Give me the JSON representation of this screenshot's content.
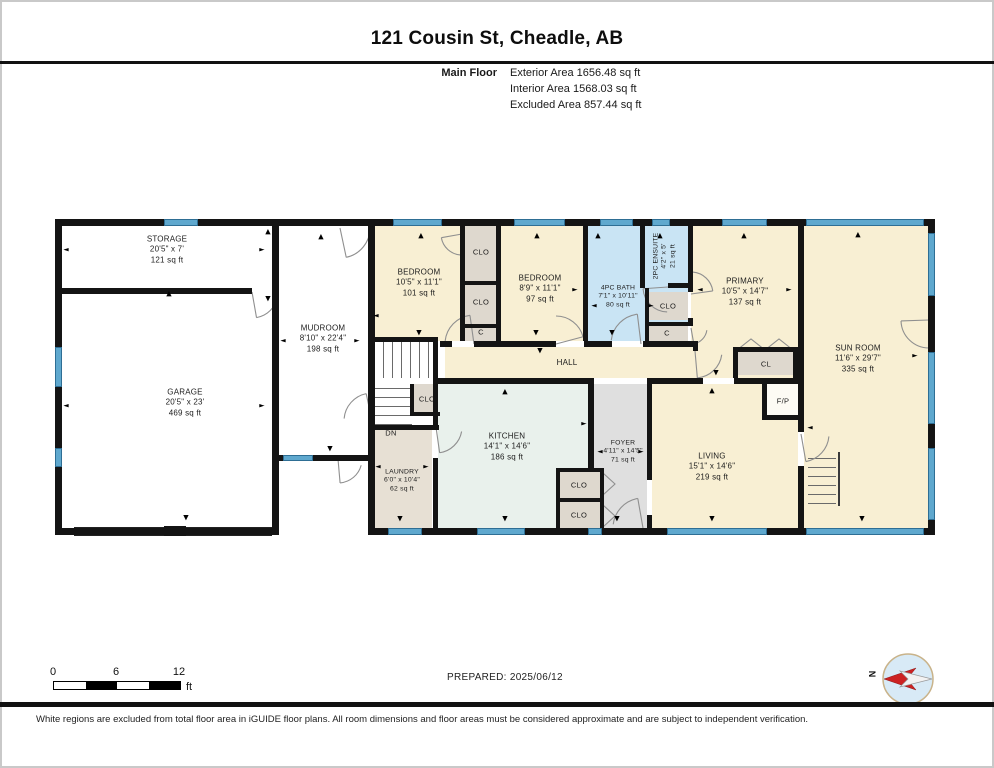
{
  "header": {
    "title": "121 Cousin St, Cheadle, AB",
    "floor_label": "Main Floor",
    "area_lines": [
      "Exterior Area 1656.48 sq ft",
      "Interior Area 1568.03 sq ft",
      "Excluded Area 857.44 sq ft"
    ]
  },
  "rooms": {
    "storage": {
      "name": "STORAGE",
      "dims": "20'5\" x 7'",
      "area": "121 sq ft"
    },
    "garage": {
      "name": "GARAGE",
      "dims": "20'5\" x 23'",
      "area": "469 sq ft"
    },
    "mudroom": {
      "name": "MUDROOM",
      "dims": "8'10\" x 22'4\"",
      "area": "198 sq ft"
    },
    "bedroom1": {
      "name": "BEDROOM",
      "dims": "10'5\" x 11'1\"",
      "area": "101 sq ft"
    },
    "bedroom2": {
      "name": "BEDROOM",
      "dims": "8'9\" x 11'1\"",
      "area": "97 sq ft"
    },
    "bath": {
      "name": "4PC BATH",
      "dims": "7'1\" x 10'11\"",
      "area": "80 sq ft"
    },
    "ensuite": {
      "name": "2PC ENSUITE",
      "dims": "4'2\" x 5'",
      "area": "21 sq ft"
    },
    "primary": {
      "name": "PRIMARY",
      "dims": "10'5\" x 14'7\"",
      "area": "137 sq ft"
    },
    "sunroom": {
      "name": "SUN ROOM",
      "dims": "11'6\" x 29'7\"",
      "area": "335 sq ft"
    },
    "hall": {
      "name": "HALL"
    },
    "kitchen": {
      "name": "KITCHEN",
      "dims": "14'1\" x 14'6\"",
      "area": "186 sq ft"
    },
    "laundry": {
      "name": "LAUNDRY",
      "dims": "6'0\" x 10'4\"",
      "area": "62 sq ft"
    },
    "foyer": {
      "name": "FOYER",
      "dims": "4'11\" x 14'5\"",
      "area": "71 sq ft"
    },
    "living": {
      "name": "LIVING",
      "dims": "15'1\" x 14'6\"",
      "area": "219 sq ft"
    }
  },
  "small_labels": {
    "clo": "CLO",
    "cl": "CL",
    "c": "C",
    "dn": "DN",
    "fp": "F/P"
  },
  "icons": {
    "up": "▲",
    "down": "▼",
    "left": "◄",
    "right": "►",
    "compass": "compass-rose"
  },
  "scale": {
    "zero": "0",
    "six": "6",
    "twelve": "12",
    "unit": "ft"
  },
  "prepared": "PREPARED: 2025/06/12",
  "compass": {
    "n": "N"
  },
  "disclaimer": "White regions are excluded from total floor area in iGUIDE floor plans. All room dimensions and floor areas must be considered approximate and are subject to independent verification.",
  "colors": {
    "room_cream": "#f8efd3",
    "wet_blue": "#c9e4f4",
    "kitchen_mint": "#e9f1ec",
    "closet_gray": "#ded8ce",
    "foyer_gray": "#dfdfdf",
    "laundry_beige": "#e7e0d4",
    "window_blue": "#5fa8ce",
    "wall_black": "#141414",
    "compass_red": "#cc2222"
  }
}
